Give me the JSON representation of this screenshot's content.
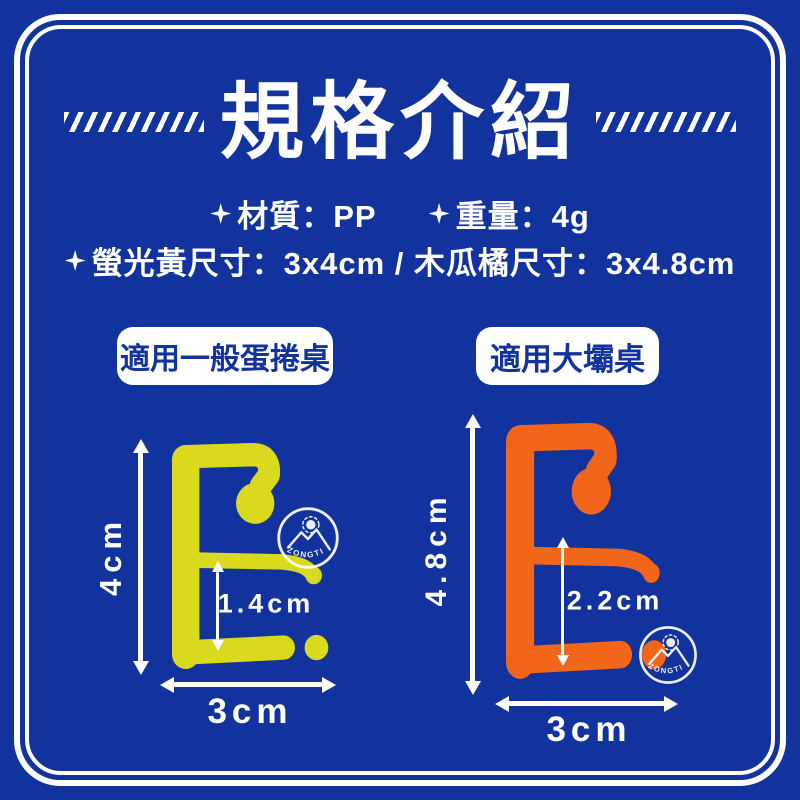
{
  "header": {
    "title": "規格介紹",
    "decoration_icon": "slash-ticks"
  },
  "specs": {
    "bullet_icon": "four-pointed-star",
    "material": "材質：PP",
    "weight": "重量：4g",
    "sizes": "螢光黃尺寸：3x4cm / 木瓜橘尺寸：3x4.8cm"
  },
  "badges": [
    {
      "label": "適用一般蛋捲桌"
    },
    {
      "label": "適用大壩桌"
    }
  ],
  "products": [
    {
      "id": "fluorescent-yellow-hook",
      "color": "#d9da1e",
      "height_label": "4cm",
      "gap_label": "1.4cm",
      "width_label": "3cm",
      "watermark": "ZONGTI"
    },
    {
      "id": "papaya-orange-hook",
      "color": "#f2661c",
      "height_label": "4.8cm",
      "gap_label": "2.2cm",
      "width_label": "3cm",
      "watermark": "ZONGTI"
    }
  ],
  "colors": {
    "background": "#12339d",
    "frame": "#ffffff",
    "text": "#ffffff",
    "badge_background": "#ffffff",
    "badge_text": "#13339c",
    "fluorescent_yellow": "#d9da1e",
    "papaya_orange": "#f2661c"
  }
}
